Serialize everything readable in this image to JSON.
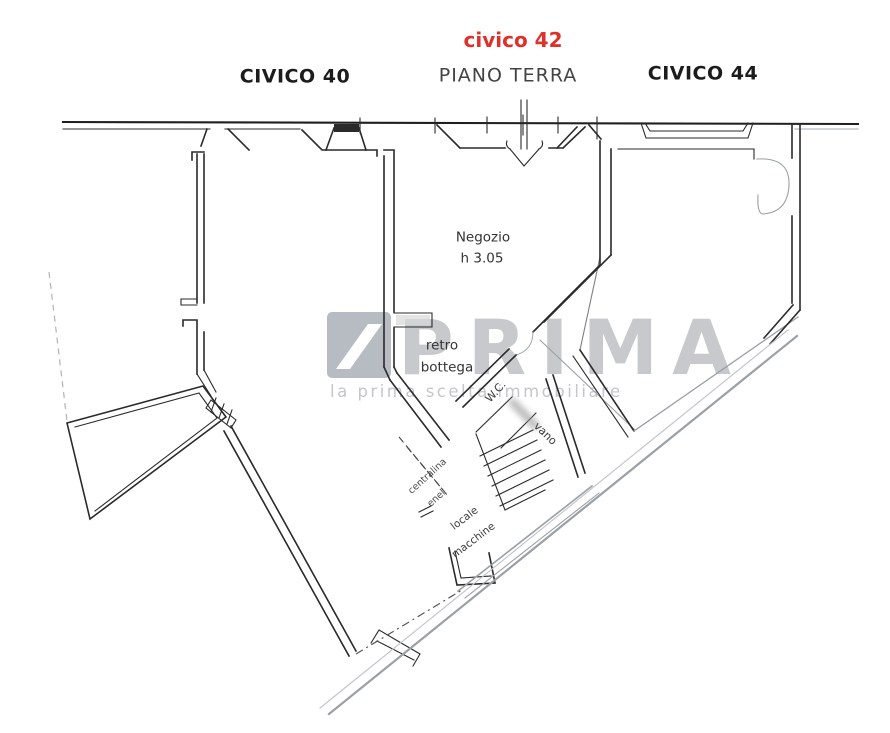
{
  "header": {
    "unit_center_top": "civico 42",
    "unit_center_sub": "PIANO TERRA",
    "unit_left": "CIVICO 40",
    "unit_right": "CIVICO 44"
  },
  "rooms": {
    "negozio": {
      "name": "Negozio",
      "height_note": "h 3.05"
    },
    "retro_bottega": {
      "line1": "retro",
      "line2": "bottega"
    },
    "wc": "W.C.",
    "stairwell": "vano",
    "centralina": {
      "line1": "centralina",
      "line2": "enel"
    },
    "locale_macchine": {
      "line1": "locale",
      "line2": "macchine"
    }
  },
  "watermark": {
    "brand": "PRIMA",
    "tagline": "la prima scelta immobiliare",
    "logo": "diagonal-stripe-square"
  },
  "colors": {
    "accent_red": "#df312b",
    "wall_ink": "#2a2a2a",
    "scan_gray": "#9aa0a4",
    "watermark_gray": "#c7c9cd",
    "background": "#ffffff"
  }
}
